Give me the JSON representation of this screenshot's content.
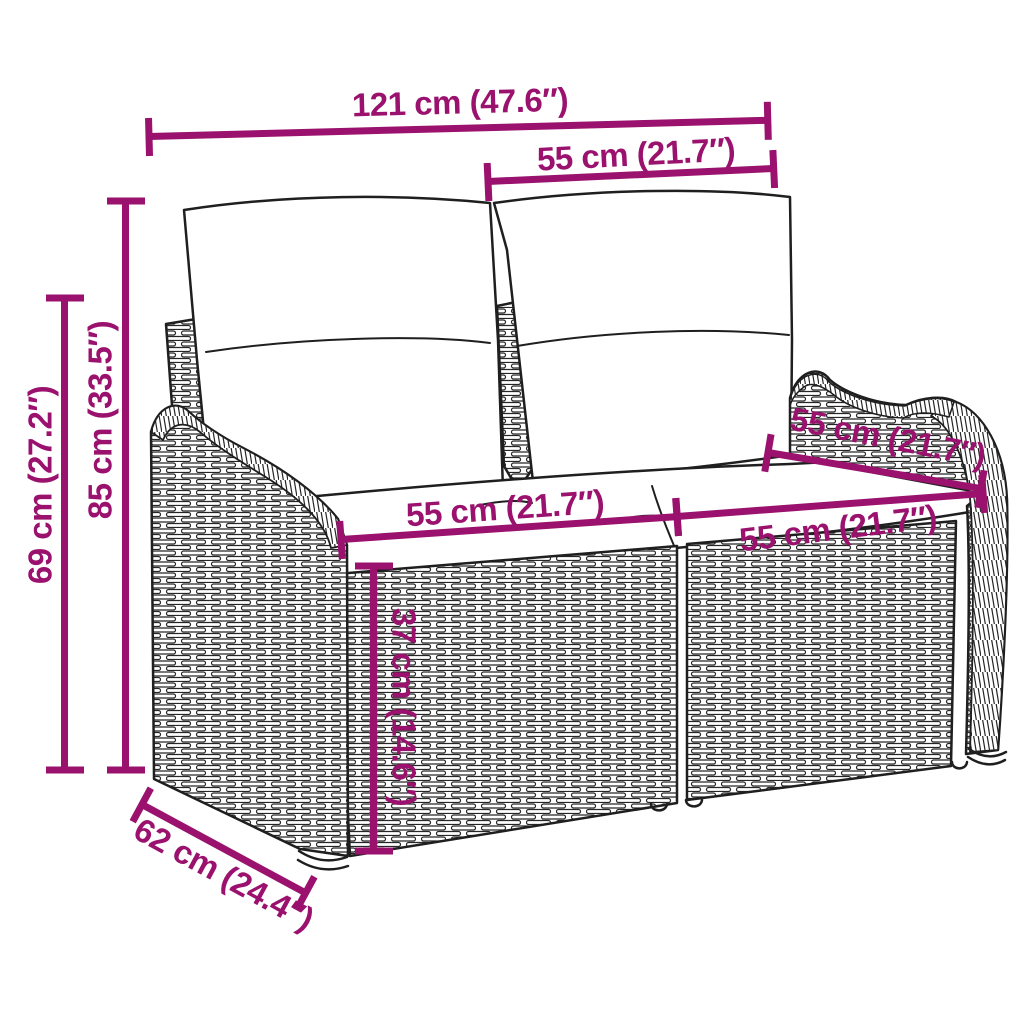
{
  "figure": {
    "style": {
      "dimension_color": "#9A116E",
      "line_art_color": "#1F1F1F",
      "background": "#FFFFFF"
    },
    "dimensions": [
      {
        "name": "total-width",
        "label": "121 cm (47.6″)",
        "value_cm": 121,
        "value_in": 47.6
      },
      {
        "name": "backrest-section-width",
        "label": "55 cm (21.7″)",
        "value_cm": 55,
        "value_in": 21.7
      },
      {
        "name": "total-height",
        "label": "85 cm (33.5″)",
        "value_cm": 85,
        "value_in": 33.5
      },
      {
        "name": "armrest-height",
        "label": "69 cm (27.2″)",
        "value_cm": 69,
        "value_in": 27.2
      },
      {
        "name": "seat-width-left",
        "label": "55 cm (21.7″)",
        "value_cm": 55,
        "value_in": 21.7
      },
      {
        "name": "seat-width-right",
        "label": "55 cm (21.7″)",
        "value_cm": 55,
        "value_in": 21.7
      },
      {
        "name": "seat-depth-top",
        "label": "55 cm (21.7″)",
        "value_cm": 55,
        "value_in": 21.7
      },
      {
        "name": "seat-height",
        "label": "37 cm (14.6″)",
        "value_cm": 37,
        "value_in": 14.6
      },
      {
        "name": "total-depth",
        "label": "62 cm (24.4″)",
        "value_cm": 62,
        "value_in": 24.4
      }
    ]
  }
}
